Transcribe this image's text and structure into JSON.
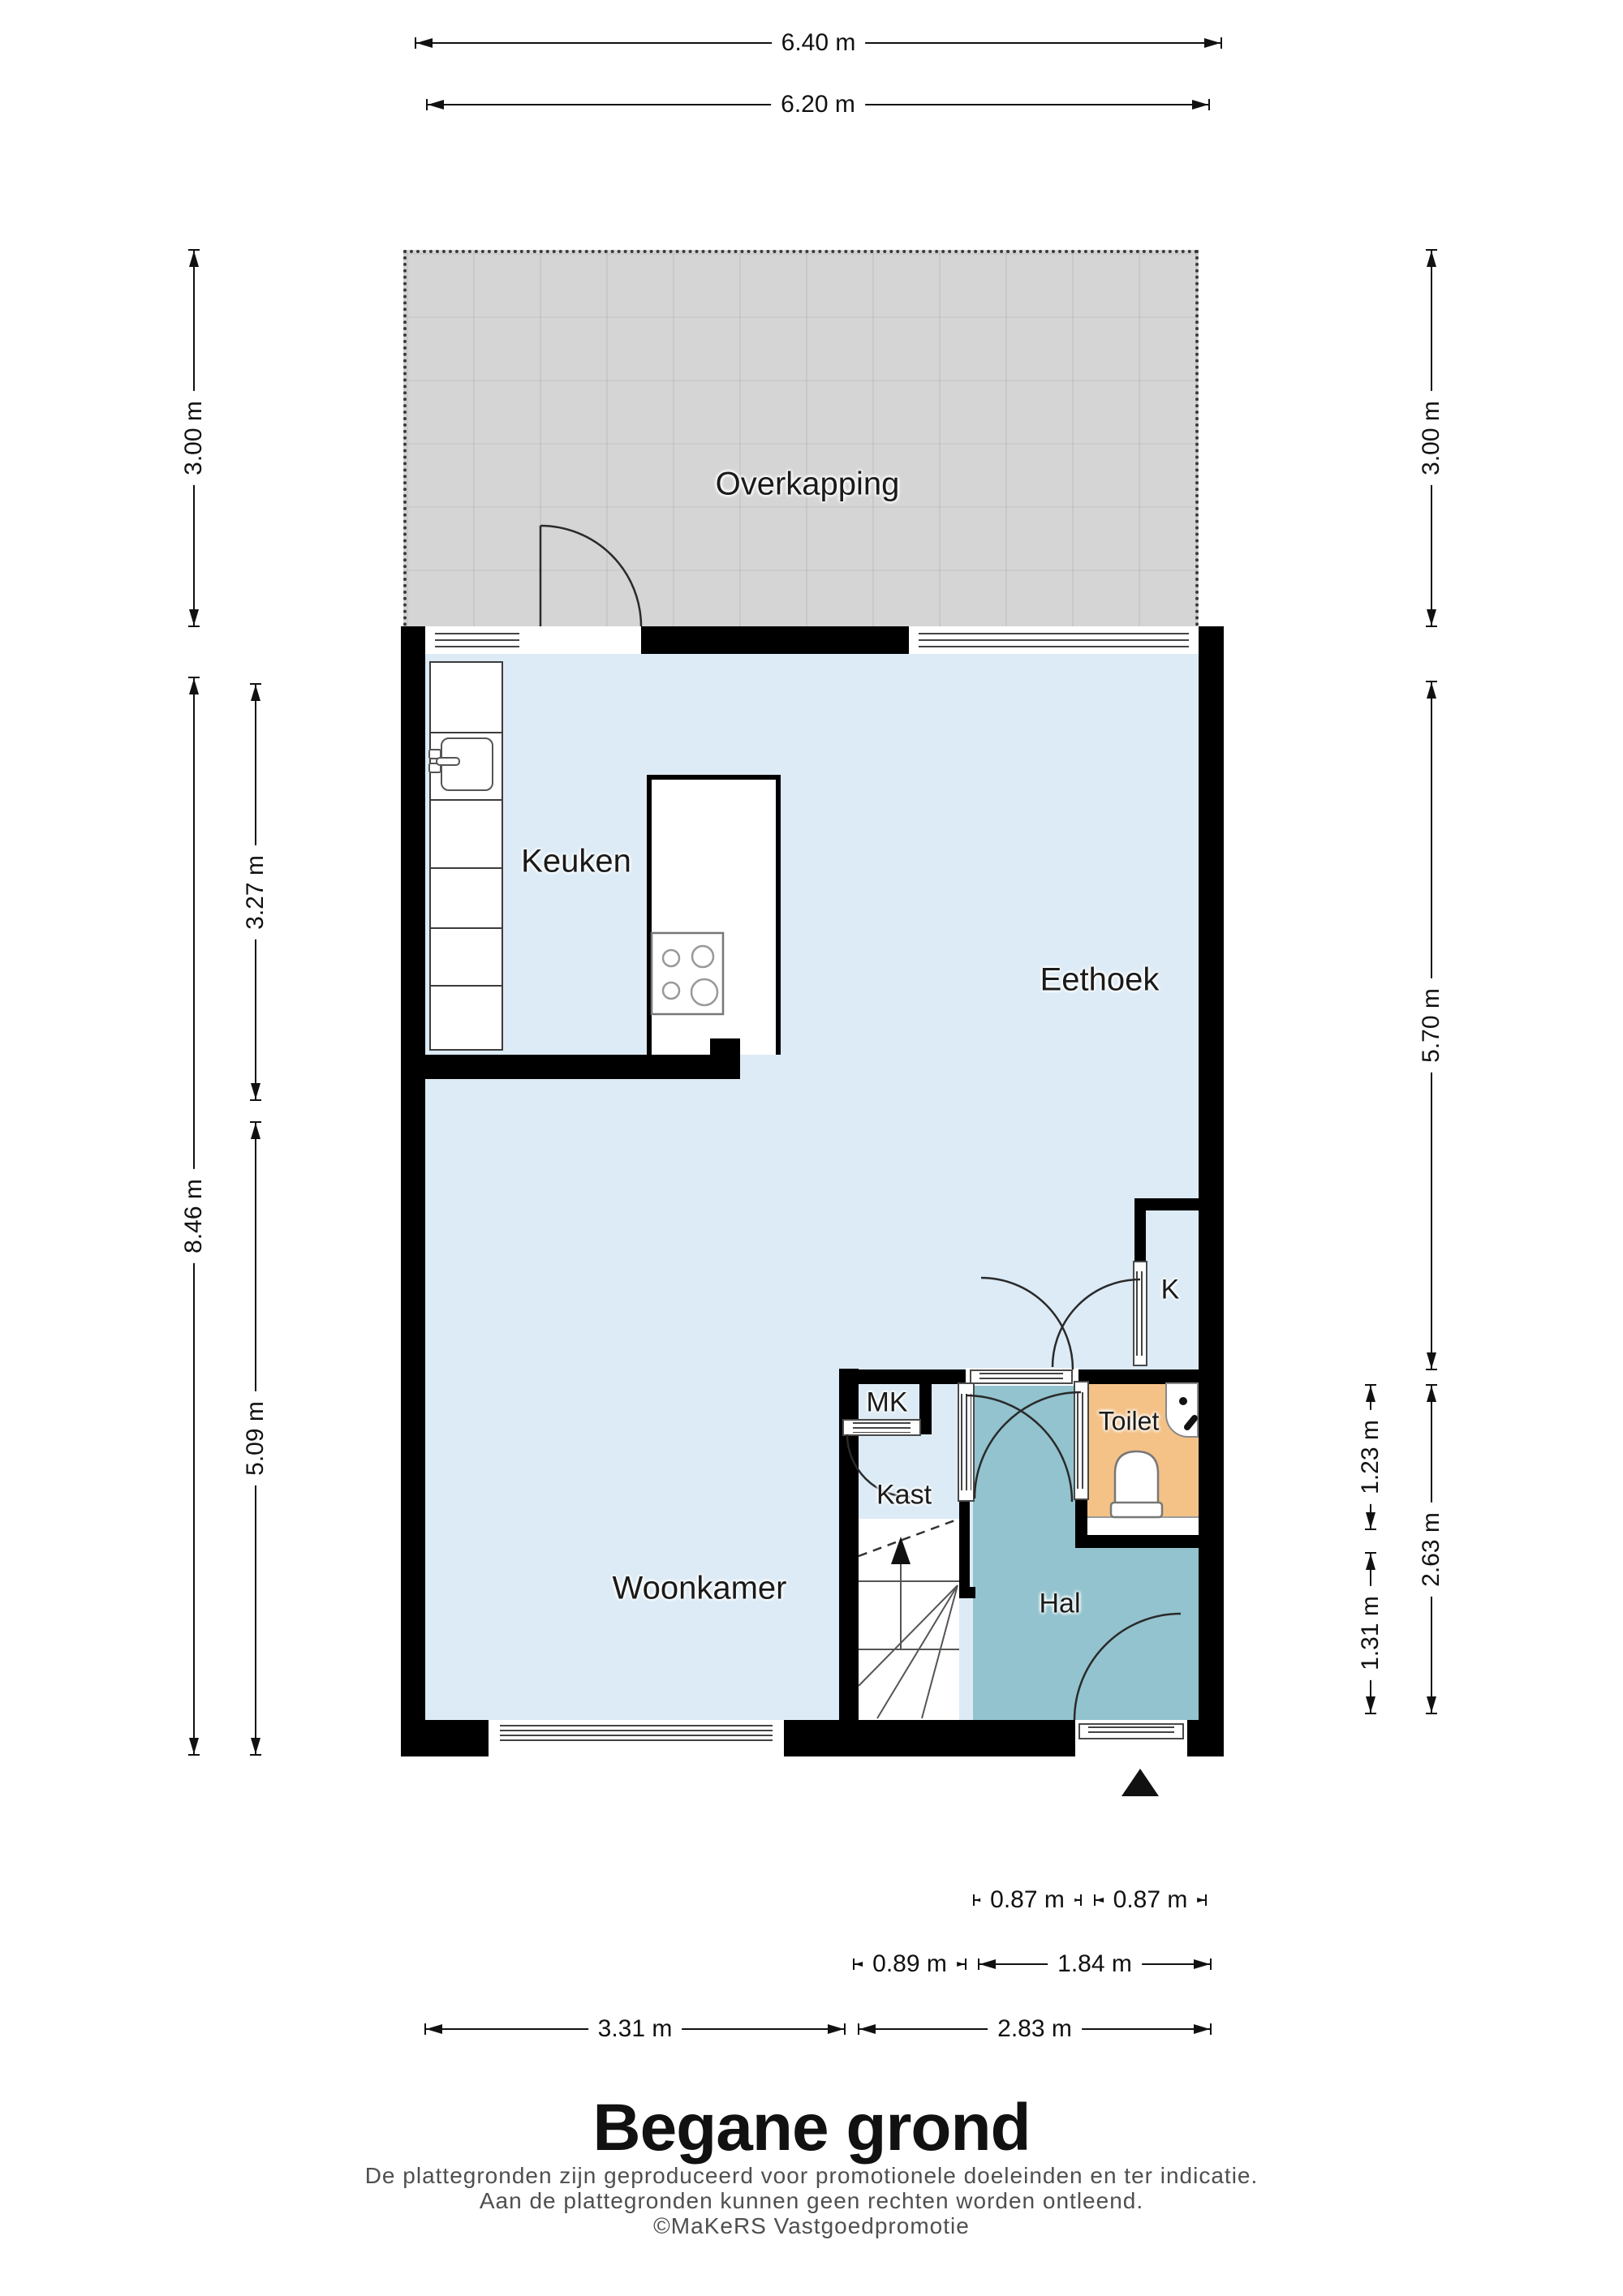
{
  "title": "Begane grond",
  "disclaimer": {
    "line1": "De plattegronden zijn geproduceerd voor promotionele doeleinden en ter indicatie.",
    "line2": "Aan de plattegronden kunnen geen rechten worden ontleend.",
    "line3": "©MaKeRS Vastgoedpromotie"
  },
  "rooms": {
    "overkapping": "Overkapping",
    "keuken": "Keuken",
    "eethoek": "Eethoek",
    "woonkamer": "Woonkamer",
    "kast": "Kast",
    "mk": "MK",
    "toilet": "Toilet",
    "hal": "Hal",
    "k": "K"
  },
  "dimensions": {
    "top": [
      "6.40 m",
      "6.20 m"
    ],
    "left": [
      "3.00 m",
      "8.46 m",
      "3.27 m",
      "5.09 m"
    ],
    "right": [
      "3.00 m",
      "5.70 m",
      "1.23 m",
      "1.31 m",
      "2.63 m"
    ],
    "bottom": [
      "0.87 m",
      "0.87 m",
      "0.89 m",
      "1.84 m",
      "3.31 m",
      "2.83 m"
    ]
  },
  "colors": {
    "floor": "#dcebf6",
    "hal_floor": "#92c3ce",
    "toilet_floor": "#f4c287",
    "overkapping_floor": "#d5d5d5",
    "wall": "#000000"
  },
  "icons": {
    "stairs_direction_arrow": "▲",
    "entrance_arrow": "▲"
  }
}
